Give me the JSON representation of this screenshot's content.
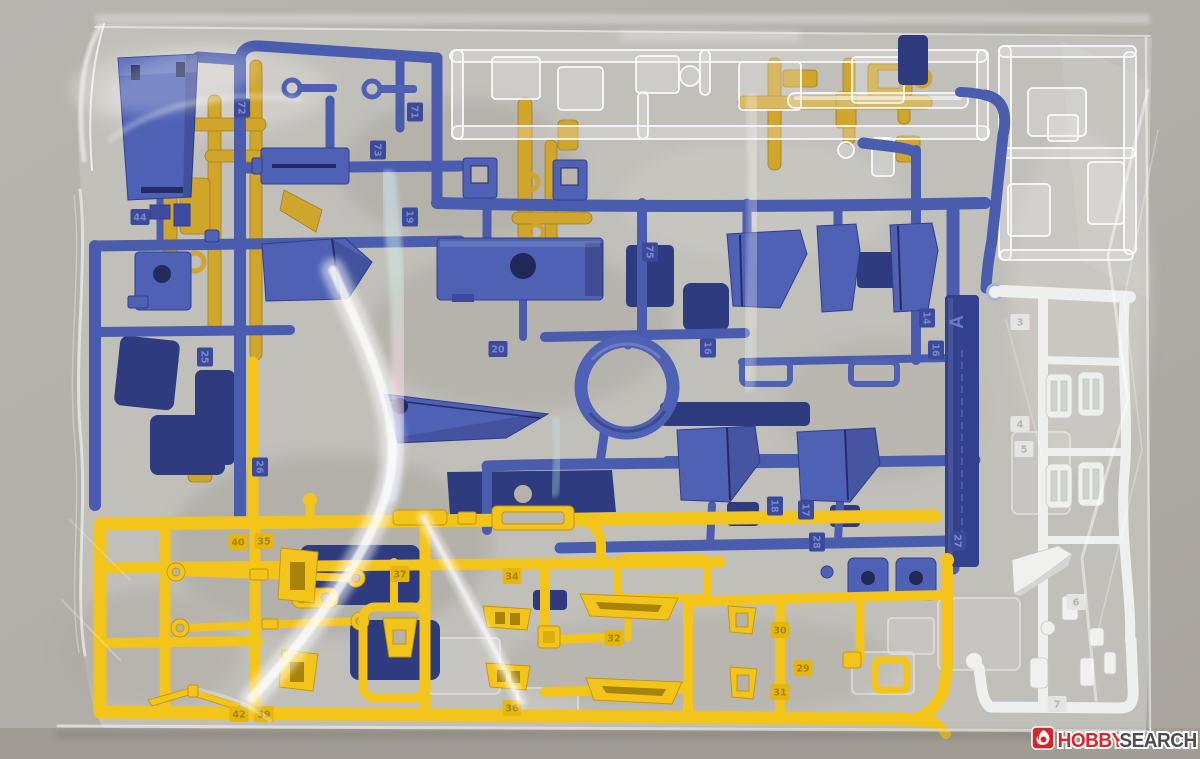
{
  "scene": {
    "description": "Photograph of plastic model kit runner sprues sealed in a clear plastic bag on a gray surface",
    "bag": "clear polybag with crinkle reflections"
  },
  "watermark": {
    "brand_first": "HOBBY",
    "brand_second": "SEARCH",
    "icon": "flame-icon",
    "icon_bg": "#d6252b",
    "first_color": "#d6252b",
    "second_color": "#4d4d4d"
  },
  "runners": {
    "blue": {
      "name": "blue runner",
      "label": "A",
      "color": "#4a5cae",
      "part_numbers": [
        "14",
        "16",
        "17",
        "18",
        "19",
        "20",
        "25",
        "26",
        "27",
        "28",
        "44",
        "71",
        "72",
        "73",
        "75"
      ]
    },
    "yellow": {
      "name": "yellow runner (front)",
      "color": "#f3c41a",
      "part_numbers": [
        "29",
        "30",
        "31",
        "32",
        "34",
        "35",
        "36",
        "37",
        "39",
        "40",
        "42"
      ]
    },
    "white": {
      "name": "white runner",
      "color": "#eef0ee",
      "part_numbers": [
        "3",
        "4",
        "5",
        "6",
        "7"
      ]
    },
    "clear": {
      "name": "clear runner",
      "color": "rgba(235,237,235,0.3)",
      "part_numbers": []
    },
    "mustard": {
      "name": "yellow runner (behind)",
      "color": "#d0a52c",
      "part_numbers": []
    }
  },
  "colors": {
    "background": "#b2afa9",
    "background_bottom": "#a29d94",
    "bag": "#c1bfba",
    "bag_highlight": "#ffffff",
    "blue": "#4f61b4",
    "blue_dark": "#2e3b7e",
    "yellow": "#f3c41a",
    "mustard": "#d0a52c",
    "white_runner": "#eef0ee",
    "tag_palette": {
      "blue": {
        "bg": "#3c4a9c",
        "fg": "#7a88cc"
      },
      "yellow": {
        "bg": "#e4b60f",
        "fg": "#a8850a"
      },
      "white": {
        "bg": "#e4e5e3",
        "fg": "#b2b4b2"
      }
    }
  },
  "part_tags": [
    {
      "c": "blue",
      "n": "72",
      "x": 242,
      "y": 108,
      "r": 90
    },
    {
      "c": "blue",
      "n": "71",
      "x": 415,
      "y": 112,
      "r": 90
    },
    {
      "c": "blue",
      "n": "73",
      "x": 378,
      "y": 150,
      "r": 90
    },
    {
      "c": "blue",
      "n": "19",
      "x": 410,
      "y": 217,
      "r": 90
    },
    {
      "c": "blue",
      "n": "44",
      "x": 140,
      "y": 217,
      "r": 0
    },
    {
      "c": "blue",
      "n": "25",
      "x": 205,
      "y": 357,
      "r": 90
    },
    {
      "c": "blue",
      "n": "20",
      "x": 498,
      "y": 349,
      "r": 0
    },
    {
      "c": "blue",
      "n": "26",
      "x": 260,
      "y": 467,
      "r": 90
    },
    {
      "c": "blue",
      "n": "75",
      "x": 650,
      "y": 252,
      "r": 90
    },
    {
      "c": "blue",
      "n": "16",
      "x": 708,
      "y": 348,
      "r": 90
    },
    {
      "c": "blue",
      "n": "14",
      "x": 927,
      "y": 318,
      "r": 90
    },
    {
      "c": "blue",
      "n": "16",
      "x": 936,
      "y": 350,
      "r": 90
    },
    {
      "c": "blue",
      "n": "18",
      "x": 775,
      "y": 506,
      "r": 90
    },
    {
      "c": "blue",
      "n": "17",
      "x": 806,
      "y": 510,
      "r": 90
    },
    {
      "c": "blue",
      "n": "28",
      "x": 817,
      "y": 542,
      "r": 90
    },
    {
      "c": "blue",
      "n": "27",
      "x": 958,
      "y": 541,
      "r": 90
    },
    {
      "c": "white",
      "n": "3",
      "x": 1020,
      "y": 322,
      "r": 0
    },
    {
      "c": "white",
      "n": "4",
      "x": 1020,
      "y": 424,
      "r": 0
    },
    {
      "c": "white",
      "n": "5",
      "x": 1024,
      "y": 449,
      "r": 0
    },
    {
      "c": "white",
      "n": "6",
      "x": 1076,
      "y": 602,
      "r": 0
    },
    {
      "c": "white",
      "n": "7",
      "x": 1057,
      "y": 704,
      "r": 0
    },
    {
      "c": "yellow",
      "n": "40",
      "x": 238,
      "y": 542,
      "r": 0
    },
    {
      "c": "yellow",
      "n": "35",
      "x": 264,
      "y": 541,
      "r": 0
    },
    {
      "c": "yellow",
      "n": "37",
      "x": 400,
      "y": 574,
      "r": 0
    },
    {
      "c": "yellow",
      "n": "42",
      "x": 239,
      "y": 714,
      "r": 0
    },
    {
      "c": "yellow",
      "n": "39",
      "x": 264,
      "y": 714,
      "r": 0
    },
    {
      "c": "yellow",
      "n": "34",
      "x": 512,
      "y": 576,
      "r": 0
    },
    {
      "c": "yellow",
      "n": "36",
      "x": 512,
      "y": 708,
      "r": 0
    },
    {
      "c": "yellow",
      "n": "32",
      "x": 614,
      "y": 638,
      "r": 0
    },
    {
      "c": "yellow",
      "n": "30",
      "x": 780,
      "y": 630,
      "r": 0
    },
    {
      "c": "yellow",
      "n": "29",
      "x": 803,
      "y": 668,
      "r": 0
    },
    {
      "c": "yellow",
      "n": "31",
      "x": 780,
      "y": 692,
      "r": 0
    }
  ]
}
